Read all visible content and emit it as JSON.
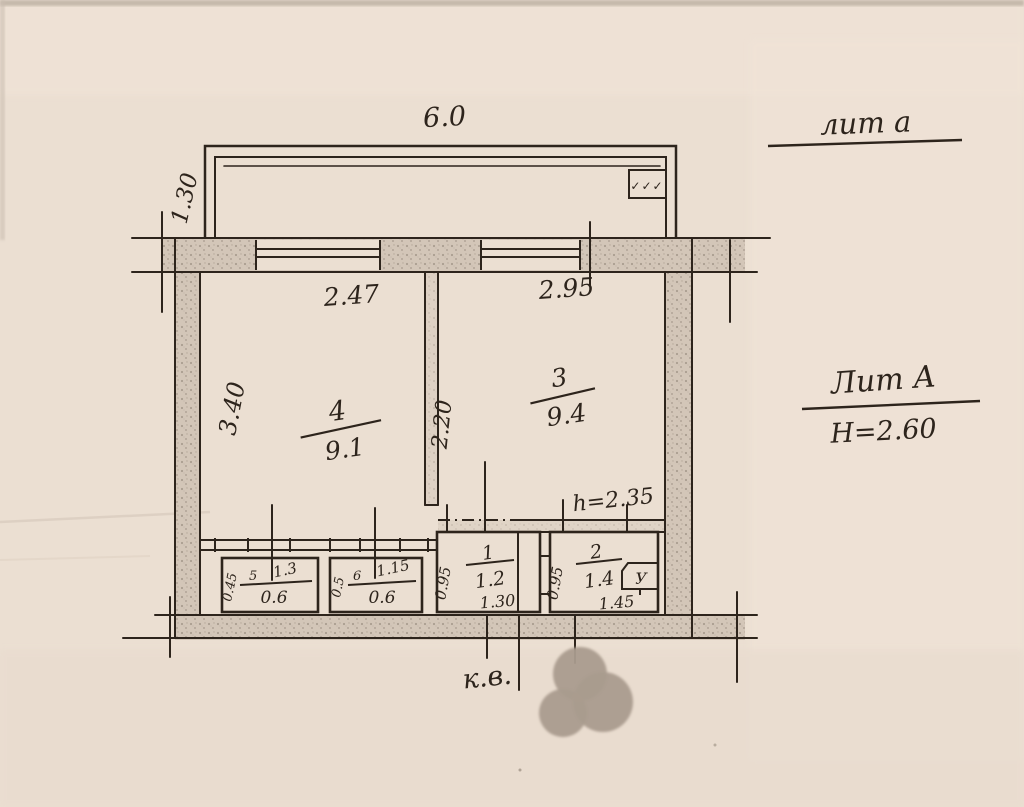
{
  "annotations": {
    "liter_note": "лит а",
    "liter_label": "Лит А",
    "building_height": "H=2.60",
    "ceiling_height": "h=2.35",
    "apartment_note": "к.в."
  },
  "balcony": {
    "width": "6.0",
    "depth": "1.30",
    "vent_marks": "✓✓✓"
  },
  "rooms": {
    "room3": {
      "number": "3",
      "area": "9.4",
      "width": "2.95"
    },
    "room4": {
      "number": "4",
      "area": "9.1",
      "width": "2.47",
      "depth": "3.40",
      "partition": "2.20"
    },
    "closet5": {
      "number": "5",
      "area": "0.6",
      "width": "1.3",
      "depth": "0.45"
    },
    "closet6": {
      "number": "6",
      "area": "0.6",
      "width": "1.15",
      "depth": "0.5"
    },
    "hall1": {
      "number": "1",
      "area": "1.2",
      "width": "1.30",
      "depth": "0.95"
    },
    "bath2": {
      "number": "2",
      "area": "1.4",
      "width": "1.45",
      "depth": "0.95",
      "fixture": "У"
    }
  },
  "colors": {
    "paper": "#ebdfd2",
    "ink": "#2d241c",
    "wall_fill": "#d3c6b8",
    "blot": "#aa9c8e"
  }
}
